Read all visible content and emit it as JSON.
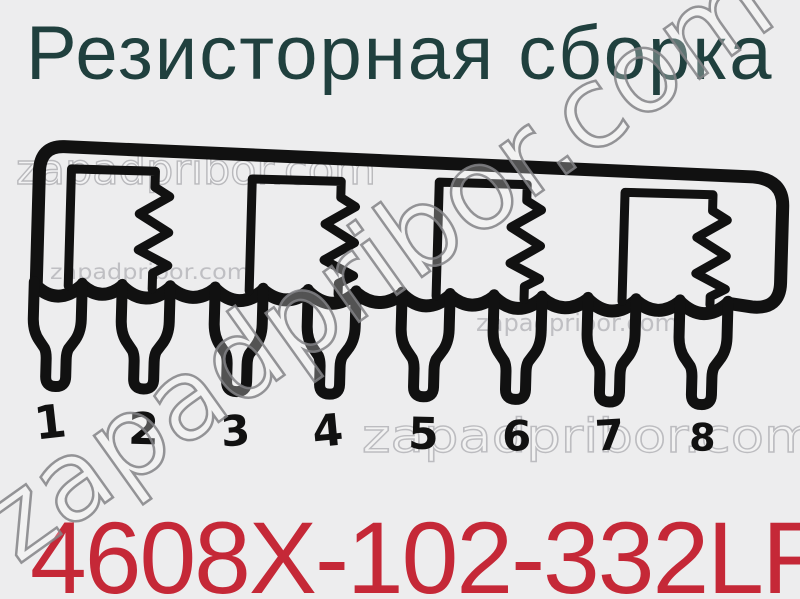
{
  "title": "Резисторная сборка",
  "part_number": "4608X-102-332LF",
  "watermark": "zapadpribor.com",
  "pins": [
    "1",
    "2",
    "3",
    "4",
    "5",
    "6",
    "7",
    "8"
  ],
  "colors": {
    "background": "#ededee",
    "title": "#20403e",
    "part_number": "#c52837",
    "line": "#111111",
    "watermark": "#96969a"
  }
}
